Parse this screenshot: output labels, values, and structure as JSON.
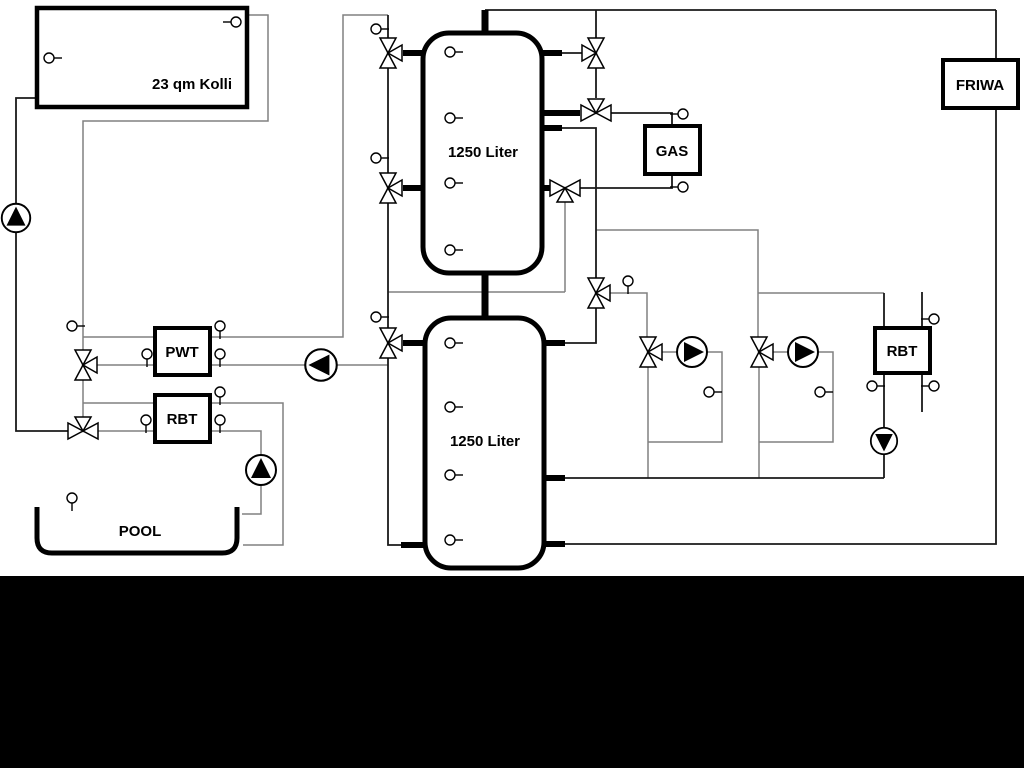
{
  "labels": {
    "collector": "23 qm Kolli",
    "tank_top": "1250 Liter",
    "tank_bottom": "1250 Liter",
    "gas": "GAS",
    "friwa": "FRIWA",
    "pwt": "PWT",
    "rbt_left": "RBT",
    "rbt_right": "RBT",
    "pool": "POOL"
  },
  "colors": {
    "background": "#ffffff",
    "pipe_gray": "#808080",
    "pipe_black": "#1a1a1a",
    "equipment_outline": "#000000",
    "footer_band": "#000000"
  },
  "icons": {
    "valve": "three-way-valve-icon",
    "pump_up": "pump-up-icon",
    "pump_down": "pump-down-icon",
    "pump_left": "pump-left-icon",
    "pump_right": "pump-right-icon",
    "sensor": "temperature-sensor-icon"
  }
}
